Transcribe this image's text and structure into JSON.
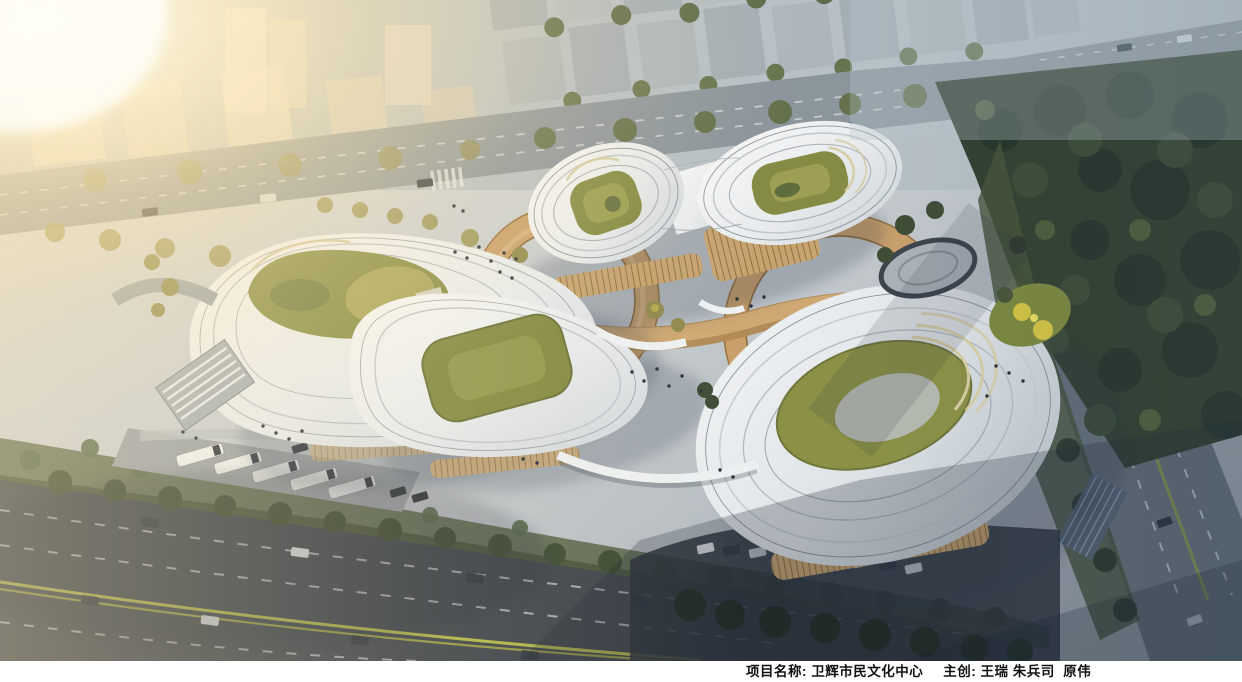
{
  "window": {
    "width_px": 1242,
    "height_px": 682
  },
  "caption_bar": {
    "project_label": "项目名称: ",
    "project_name": "卫辉市民文化中心",
    "creator_label": "主创: ",
    "creators": "王瑞 朱兵司  原伟",
    "background": "#ffffff",
    "text_color": "#111111"
  },
  "scene": {
    "type": "aerial-architectural-rendering",
    "subject": "卫辉市民文化中心",
    "palette": {
      "sun_glow": "#fff3d6",
      "plaza": "#c9ced2",
      "building_shell": "#f2f4f5",
      "courtyard_green": "#8a8f47",
      "terrace_tan": "#c9a06b",
      "road_dark": "#3d444b",
      "road_light": "#8b959c",
      "forest_green": "#32402f",
      "lane_yellow": "#c6c949",
      "shadow_blue": "#2c3848",
      "caption_bg": "#ffffff"
    }
  }
}
